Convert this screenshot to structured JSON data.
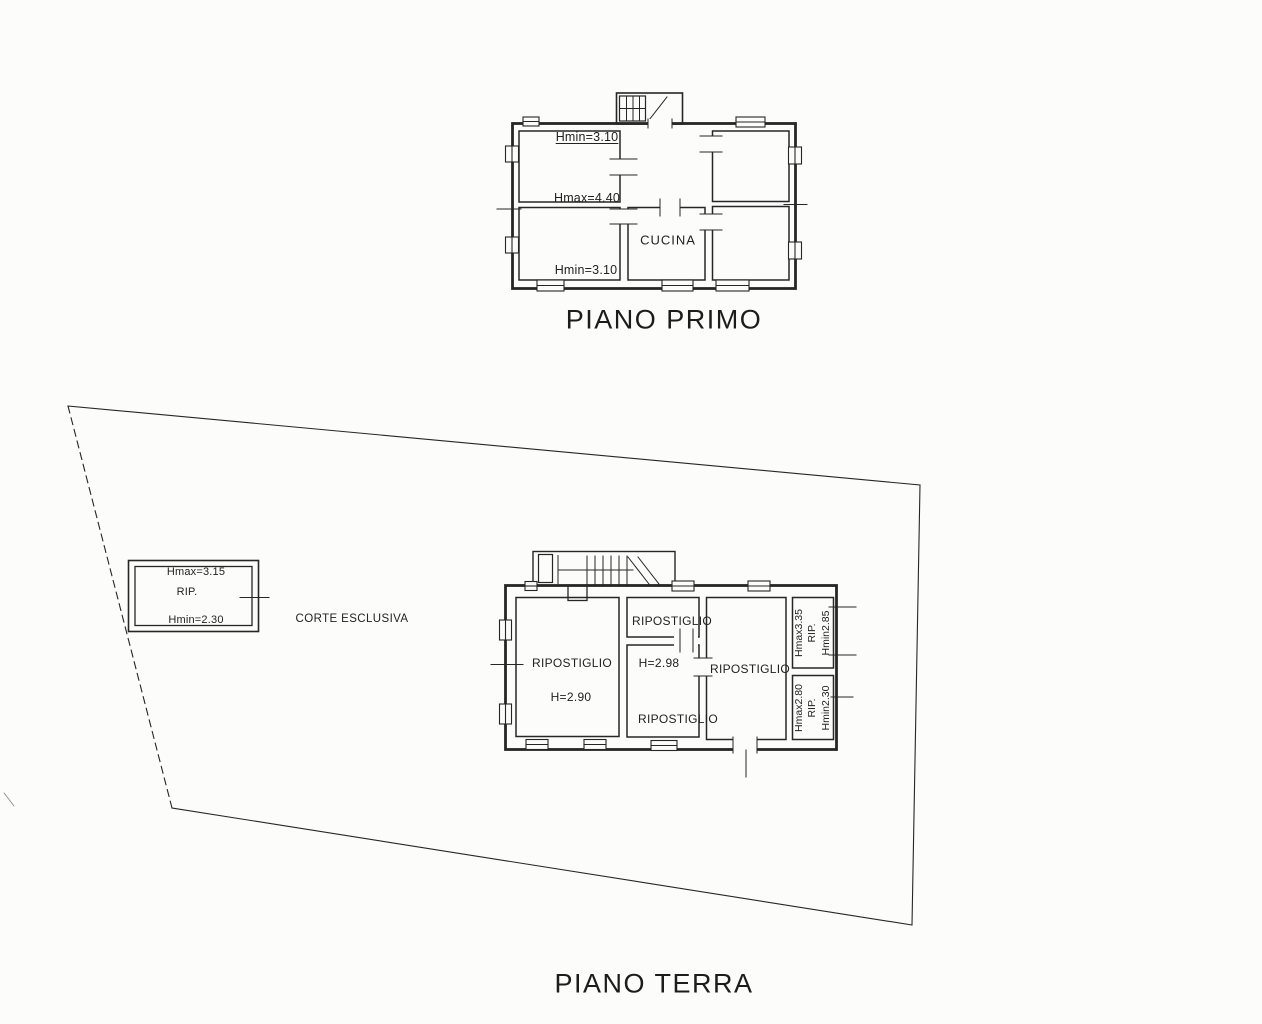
{
  "palette": {
    "ink": "#262626",
    "paper": "#fcfcfb"
  },
  "piano_primo": {
    "title": "PIANO PRIMO",
    "room_top_left_height": "Hmin=3.10",
    "divider_height": "Hmax=4.40",
    "room_bottom_left_height": "Hmin=3.10",
    "kitchen_label": "CUCINA"
  },
  "piano_terra": {
    "title": "PIANO TERRA",
    "courtyard_label": "CORTE ESCLUSIVA",
    "annex": {
      "hmax": "Hmax=3.15",
      "name": "RIP.",
      "hmin": "Hmin=2.30"
    },
    "room_left_name": "RIPOSTIGLIO",
    "room_left_height": "H=2.90",
    "room_mid_top_name": "RIPOSTIGLIO",
    "room_mid_height": "H=2.98",
    "room_mid_name": "RIPOSTIGLIO",
    "room_right_name": "RIPOSTIGLIO",
    "room_small_top": {
      "hmax": "Hmax3.35",
      "name": "RIP.",
      "hmin": "Hmin2.85"
    },
    "room_small_bottom": {
      "hmax": "Hmax2.80",
      "name": "RIP.",
      "hmin": "Hmin2.30"
    }
  }
}
